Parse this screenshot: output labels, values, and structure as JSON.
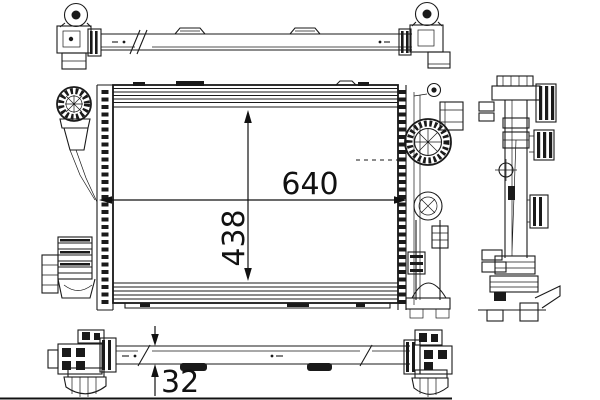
{
  "page": {
    "background": "#ffffff"
  },
  "drawing": {
    "type": "technical-drawing",
    "subject": "radiator",
    "line_color": "#1a1a1a",
    "dimension_labels": {
      "width": "640",
      "height": "438",
      "thickness": "32"
    }
  }
}
